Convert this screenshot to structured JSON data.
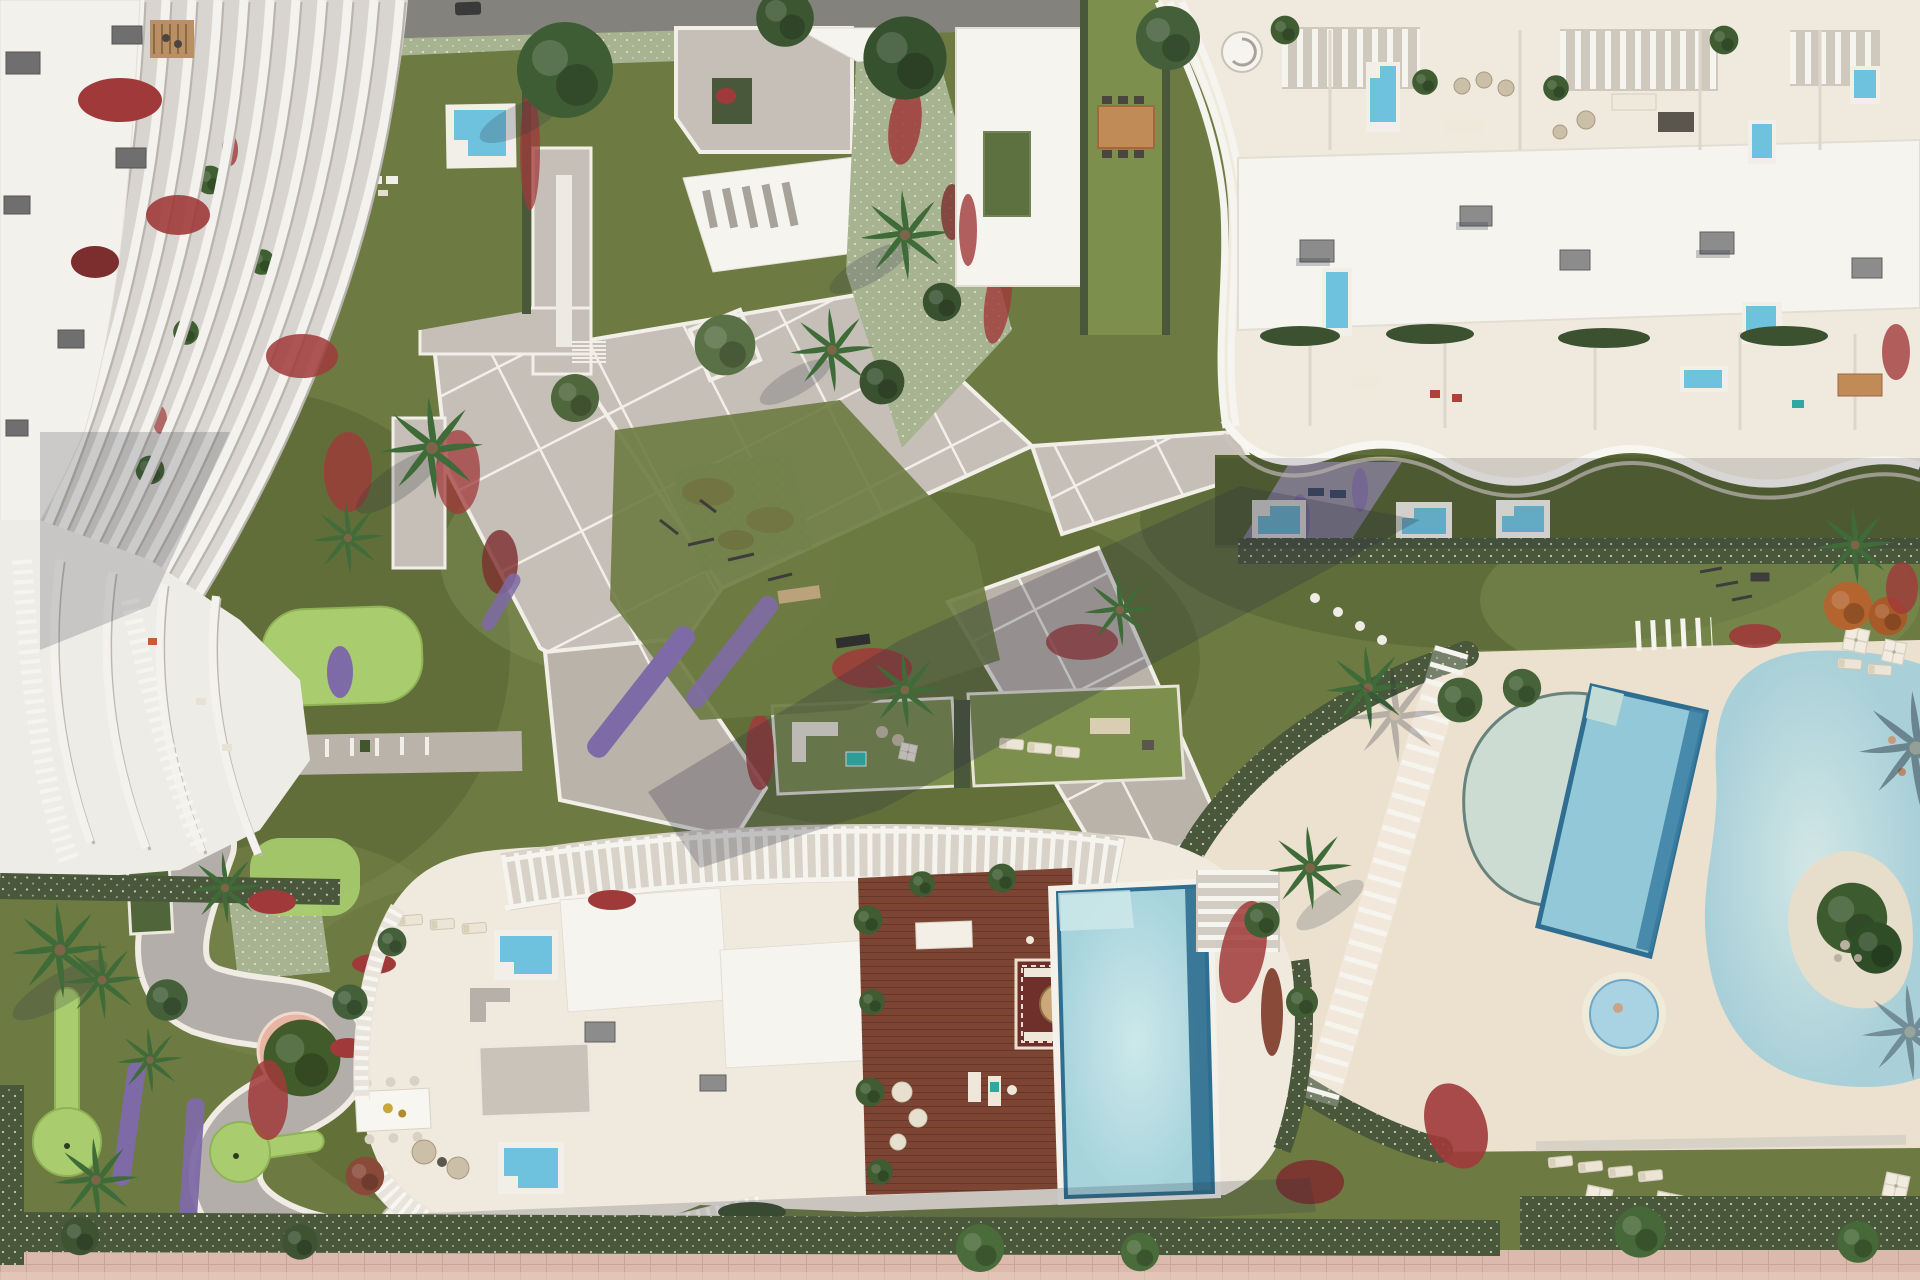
{
  "meta": {
    "title": "Top-down aerial 3D render of a coastal residential resort complex",
    "view": "orthographic top-down",
    "time_of_day": "sunny, shadows cast to the south-west"
  },
  "palette": {
    "lawn-olive": "#6d7b43",
    "lawn-bright": "#7d8f4d",
    "golf-green": "#a9cd6e",
    "paving": "#c5bfb7",
    "paving-warm": "#bab3aa",
    "road": "#84827d",
    "roof-white": "#f6f4ef",
    "building-cream": "#f0eade",
    "deck-cream": "#ece1cf",
    "hedge": "#49573a",
    "flower-red": "#a03a3a",
    "flower-purple": "#7e6aa6",
    "groundcover-sage": "#a8b392",
    "wood-deck": "#7b4433",
    "pool-plunge": "#6ec2de",
    "pool-lap": "#92c8d8",
    "pool-lagoon": "#b4d6dc",
    "shadow": "#2c3040",
    "promenade-pink": "#dbb9ad",
    "palm-green": "#3e6b38",
    "tree-green": "#44603a",
    "wood-furniture": "#c08b57",
    "rug-maroon": "#6f2f2a",
    "teal-accent": "#2ea8a0",
    "planter-pink": "#e8b4a4"
  },
  "scene": {
    "regions": [
      {
        "id": "left-building",
        "label": "West residential building with curved white louver fins and roof terraces"
      },
      {
        "id": "top-roof-terraces",
        "label": "Central roof terraces with paved decks, stairs and planted gardens"
      },
      {
        "id": "right-building",
        "label": "North-east residential building with rooftop plunge pools, pergolas and wavy balconies"
      },
      {
        "id": "central-plaza",
        "label": "Diagonal paved plaza with white grid joints, palms and flower beds"
      },
      {
        "id": "gym-lawn",
        "label": "Outdoor gym lawn"
      },
      {
        "id": "amenity-terraces",
        "label": "Furnished green amenity terraces"
      },
      {
        "id": "bottom-building",
        "label": "South building with rooftop wood deck, infinity pool and pergola slats"
      },
      {
        "id": "pool-deck",
        "label": "Communal lagoon pool deck with jacuzzi, lap pool and sandy island pool"
      },
      {
        "id": "mini-golf",
        "label": "Mini-golf putting garden with winding path and pink planter"
      },
      {
        "id": "promenade",
        "label": "Pink beachfront promenade with hedge"
      }
    ],
    "water_features": [
      "lagoon pool with sandy island",
      "tilted lap pool with dark deep lane",
      "half-moon shallow pool",
      "round jacuzzi with swimmer",
      "rooftop infinity pool with dark border",
      "multiple private plunge pools"
    ],
    "amenities": [
      "outdoor gym",
      "mini-golf lanes",
      "outdoor dining tables",
      "sun loungers",
      "white parasols",
      "sunken lounge with rug",
      "spiral staircases",
      "pergola walkway"
    ],
    "vegetation": [
      "palm trees",
      "round canopy trees",
      "red bougainvillea beds",
      "purple flower strips",
      "white-speckled hedges",
      "olive lawns"
    ]
  }
}
